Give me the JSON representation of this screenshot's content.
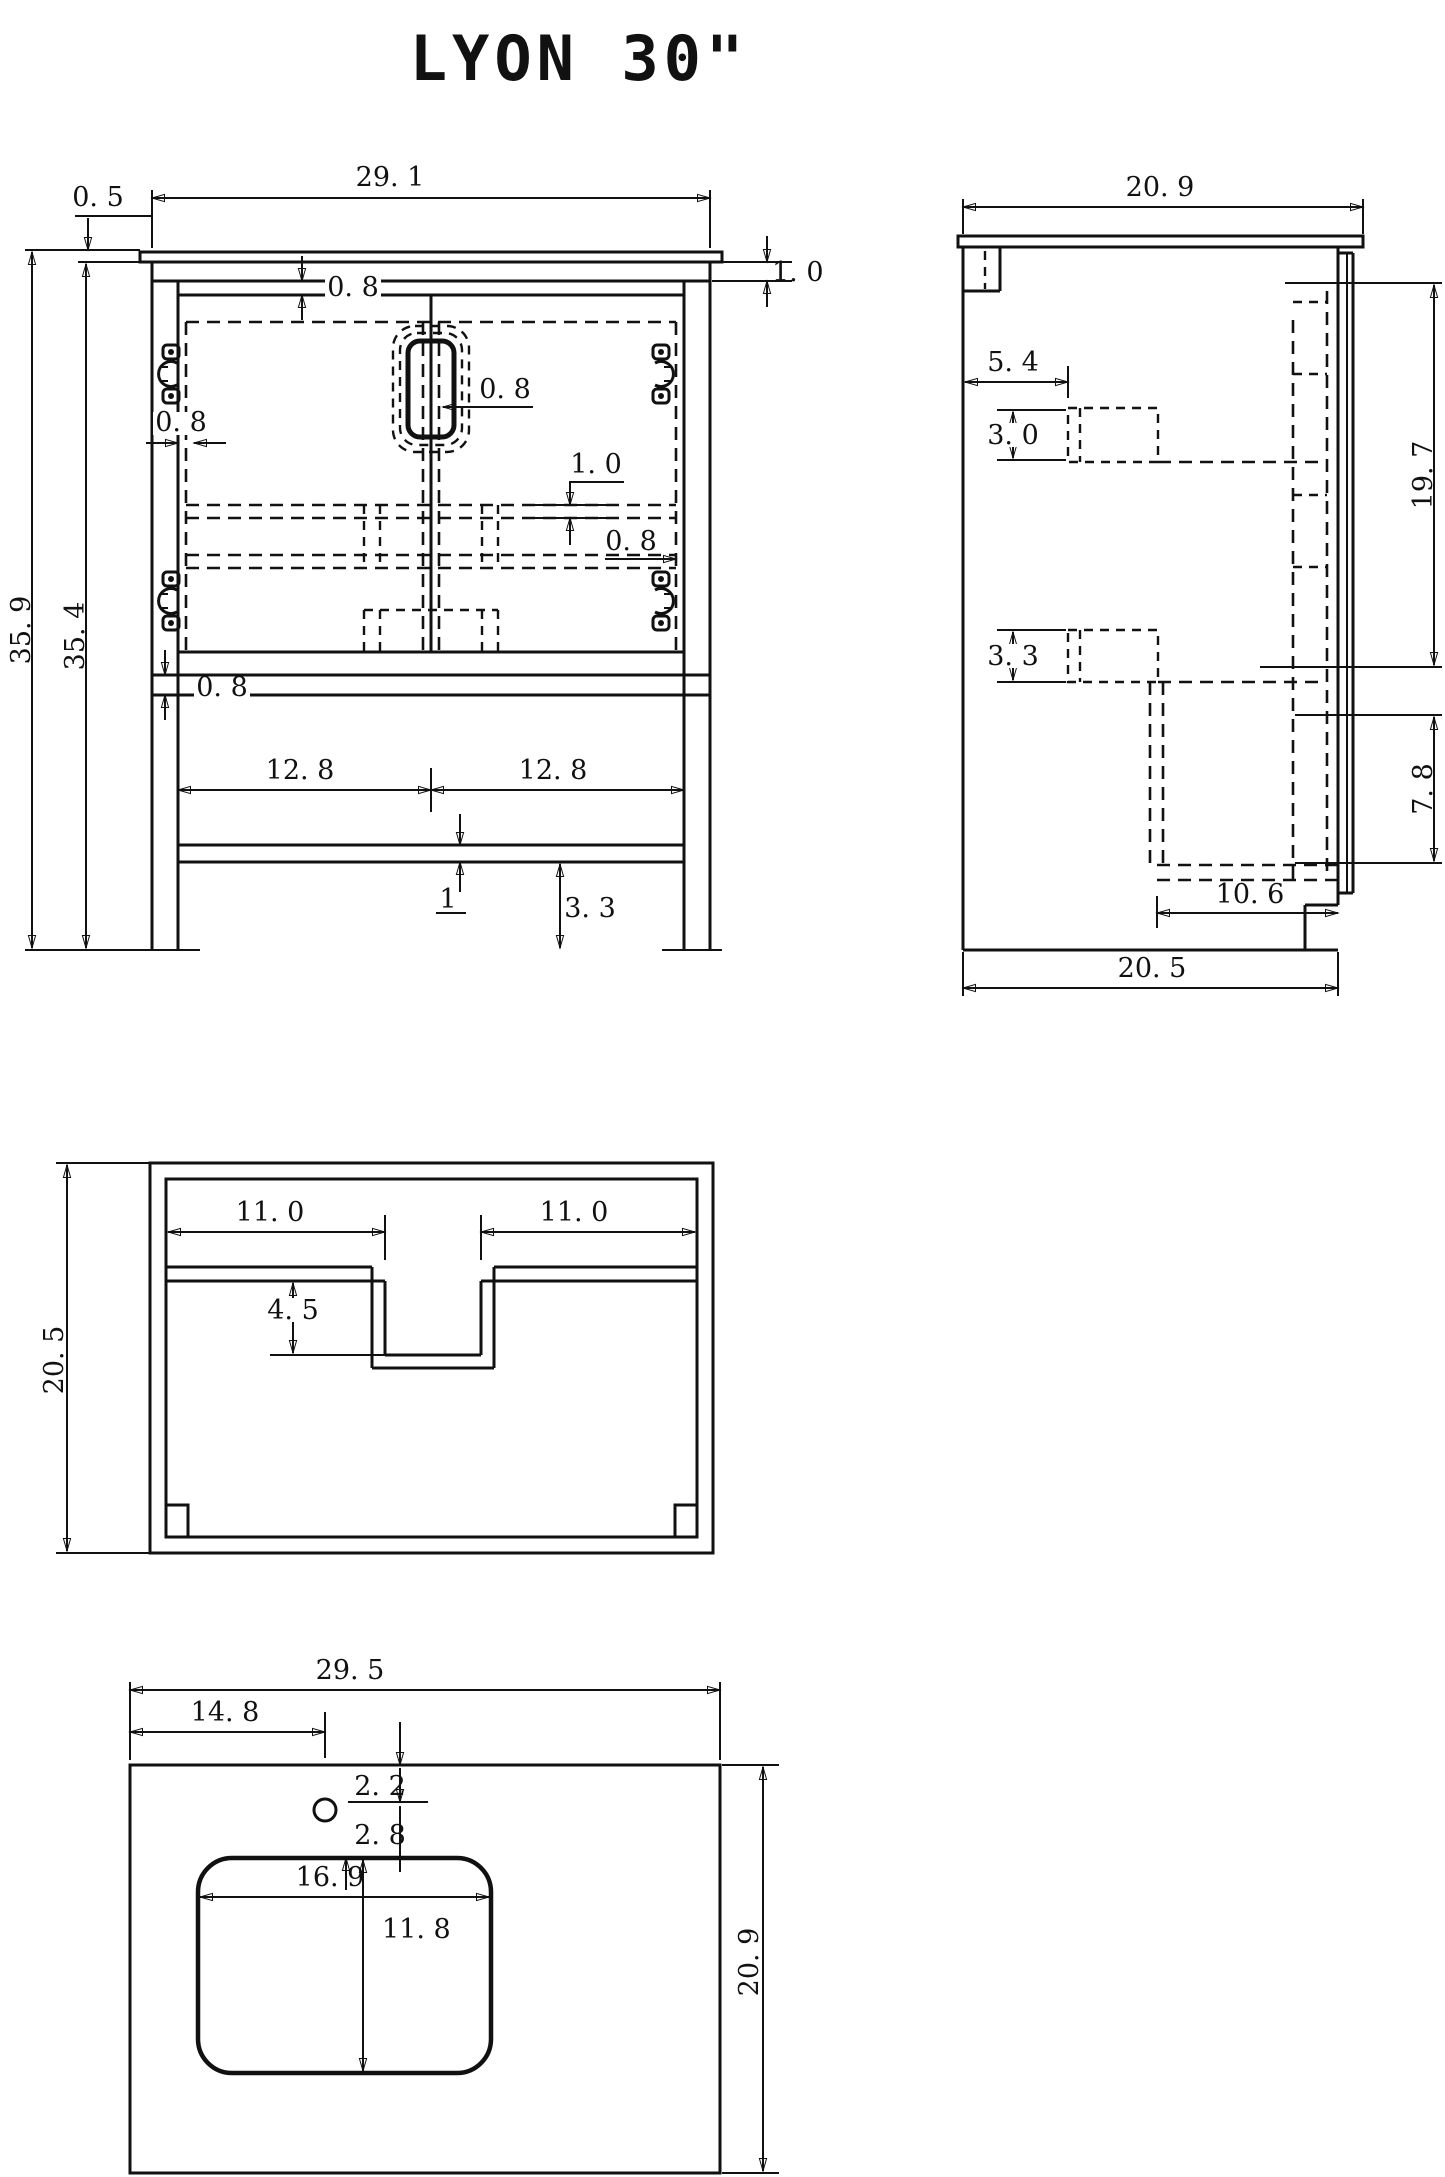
{
  "title": "LYON 30\"",
  "views": {
    "front": {
      "name": "front elevation",
      "dims": {
        "w": "29. 1",
        "overhang": "0. 5",
        "h_total": "35. 9",
        "h_body": "35. 4",
        "gap_top": "0. 8",
        "gap_left": "0. 8",
        "gap_right_up": "0. 8",
        "gap_right_low": "0. 8",
        "gap_bottom": "0. 8",
        "top_thk": "1. 0",
        "rail_thk": "1. 0",
        "door_left": "12. 8",
        "door_right": "12. 8",
        "shelf_thk": "1",
        "foot_h": "3. 3"
      }
    },
    "side": {
      "name": "side section",
      "dims": {
        "depth_top": "20. 9",
        "back_inset": "5. 4",
        "rail_upper": "3. 0",
        "rail_lower": "3. 3",
        "door_h": "19. 7",
        "open_h": "7. 8",
        "shelf_d": "10. 6",
        "depth_body": "20. 5"
      }
    },
    "plan": {
      "name": "plan view",
      "dims": {
        "depth": "20. 5",
        "left_w": "11. 0",
        "right_w": "11. 0",
        "notch_d": "4. 5"
      }
    },
    "counter": {
      "name": "countertop with sink",
      "dims": {
        "width": "29. 5",
        "faucet_x": "14. 8",
        "faucet_front": "2. 2",
        "faucet_back": "2. 8",
        "sink_w": "16. 9",
        "sink_d": "11. 8",
        "depth": "20. 9"
      }
    }
  }
}
